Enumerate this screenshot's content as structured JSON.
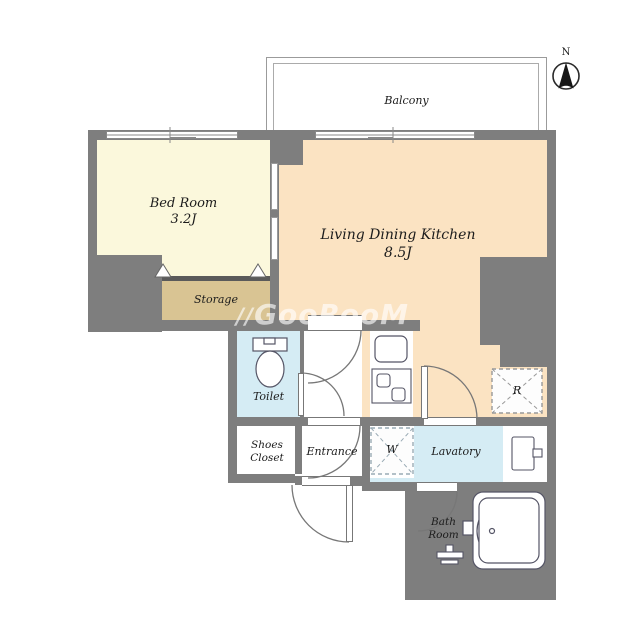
{
  "compass": {
    "label": "N"
  },
  "watermark": {
    "icon": "//",
    "text": "GooRooM"
  },
  "rooms": {
    "balcony": {
      "name": "Balcony"
    },
    "bedroom": {
      "name": "Bed Room",
      "area": "3.2J"
    },
    "ldk": {
      "name": "Living Dining Kitchen",
      "area": "8.5J"
    },
    "storage": {
      "name": "Storage"
    },
    "toilet": {
      "name": "Toilet"
    },
    "shoes_closet": {
      "line1": "Shoes",
      "line2": "Closet"
    },
    "entrance": {
      "name": "Entrance"
    },
    "washing_machine": {
      "abbr": "W"
    },
    "lavatory": {
      "name": "Lavatory"
    },
    "refrigerator": {
      "abbr": "R"
    },
    "bathroom": {
      "line1": "Bath",
      "line2": "Room"
    }
  },
  "colors": {
    "wall": "#7E7E7E",
    "bedroom_floor": "#FBF8DC",
    "ldk_floor": "#FBE3C2",
    "storage_floor": "#D9C493",
    "wet_area_floor": "#D5ECF4",
    "fixture_outline": "#556",
    "door_arc": "#777777"
  }
}
